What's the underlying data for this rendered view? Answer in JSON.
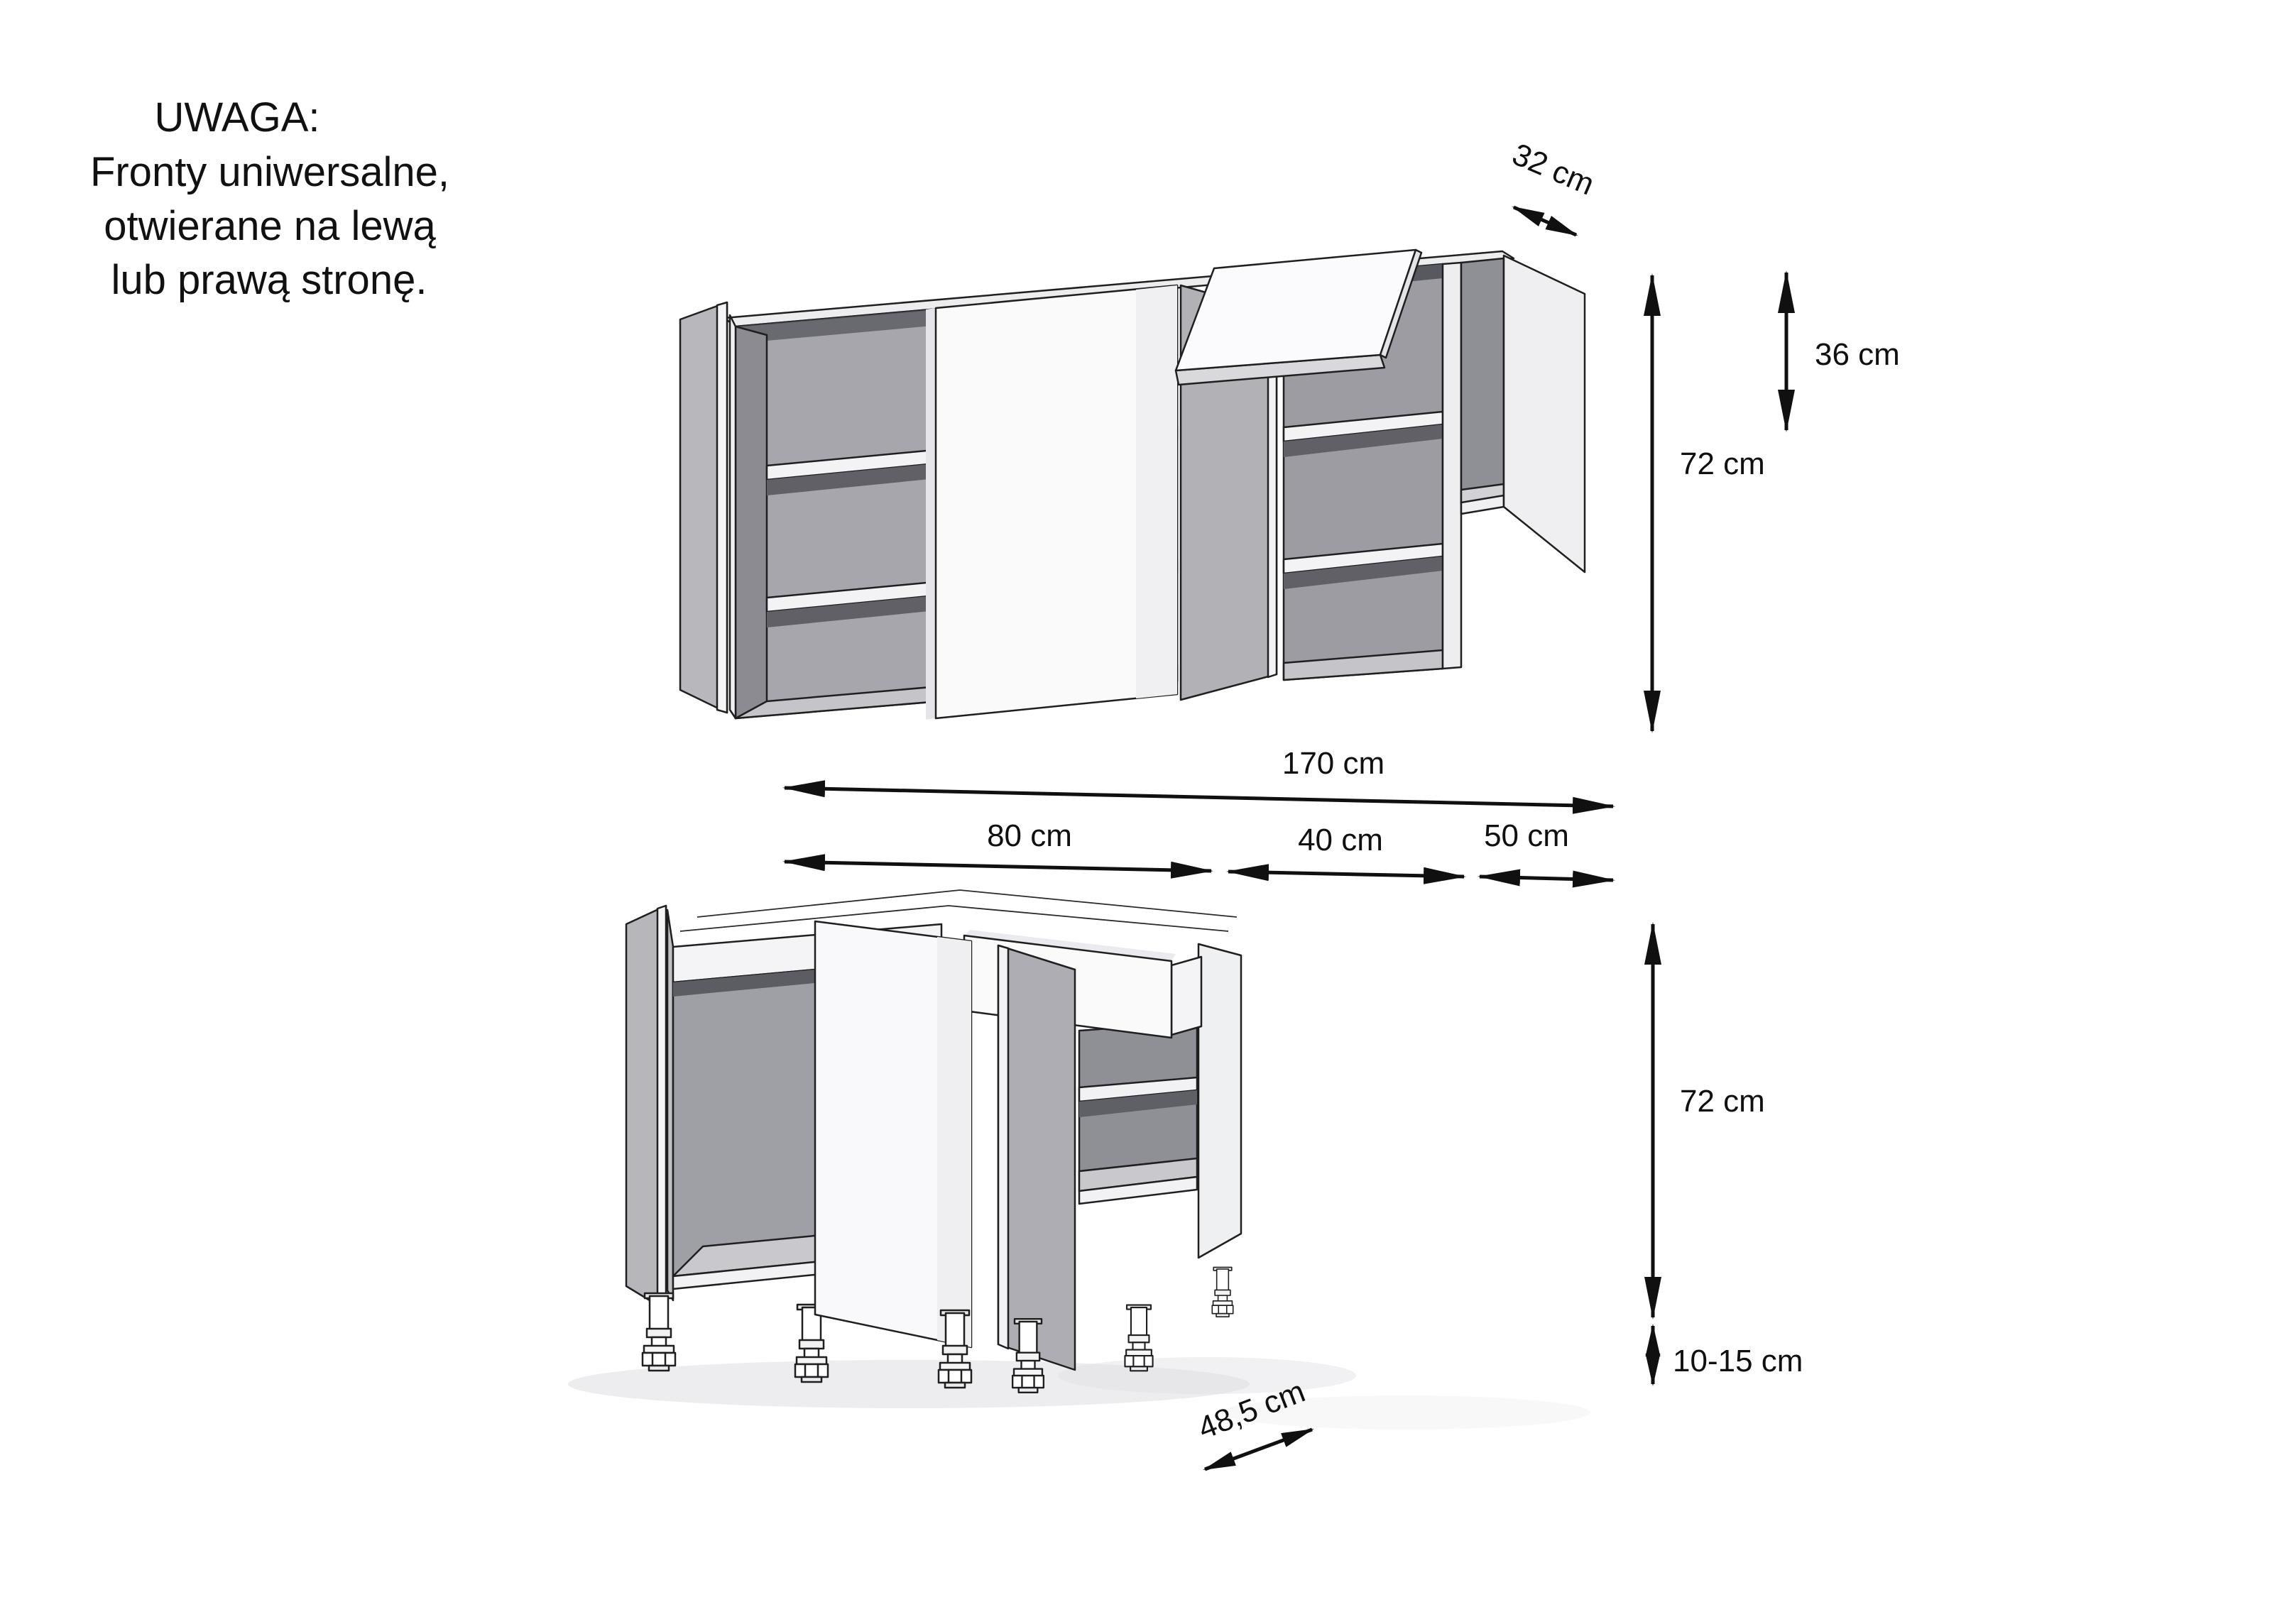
{
  "note": {
    "line1": "UWAGA:",
    "line2": "Fronty uniwersalne,",
    "line3": "otwierane na lewą",
    "line4": "lub prawą stronę."
  },
  "dimensions": {
    "wall_depth": "32 cm",
    "wall_flip_height": "36 cm",
    "wall_height": "72 cm",
    "total_width": "170 cm",
    "unit1_width": "80 cm",
    "unit2_width": "40 cm",
    "unit3_width": "50 cm",
    "base_height": "72 cm",
    "legs_height": "10-15 cm",
    "base_depth": "48,5 cm"
  },
  "colors": {
    "background": "#ffffff",
    "line": "#1f1f1f",
    "dimension": "#101010",
    "panel_gray": "#b6b6bb",
    "interior_gray": "#9fa0a6",
    "interior_dark": "#8f8f96",
    "shelf_shadow": "#5f5f66",
    "front_white": "#fafafb",
    "edge_white": "#f3f3f5",
    "bottom_gray": "#c6c6cb"
  }
}
